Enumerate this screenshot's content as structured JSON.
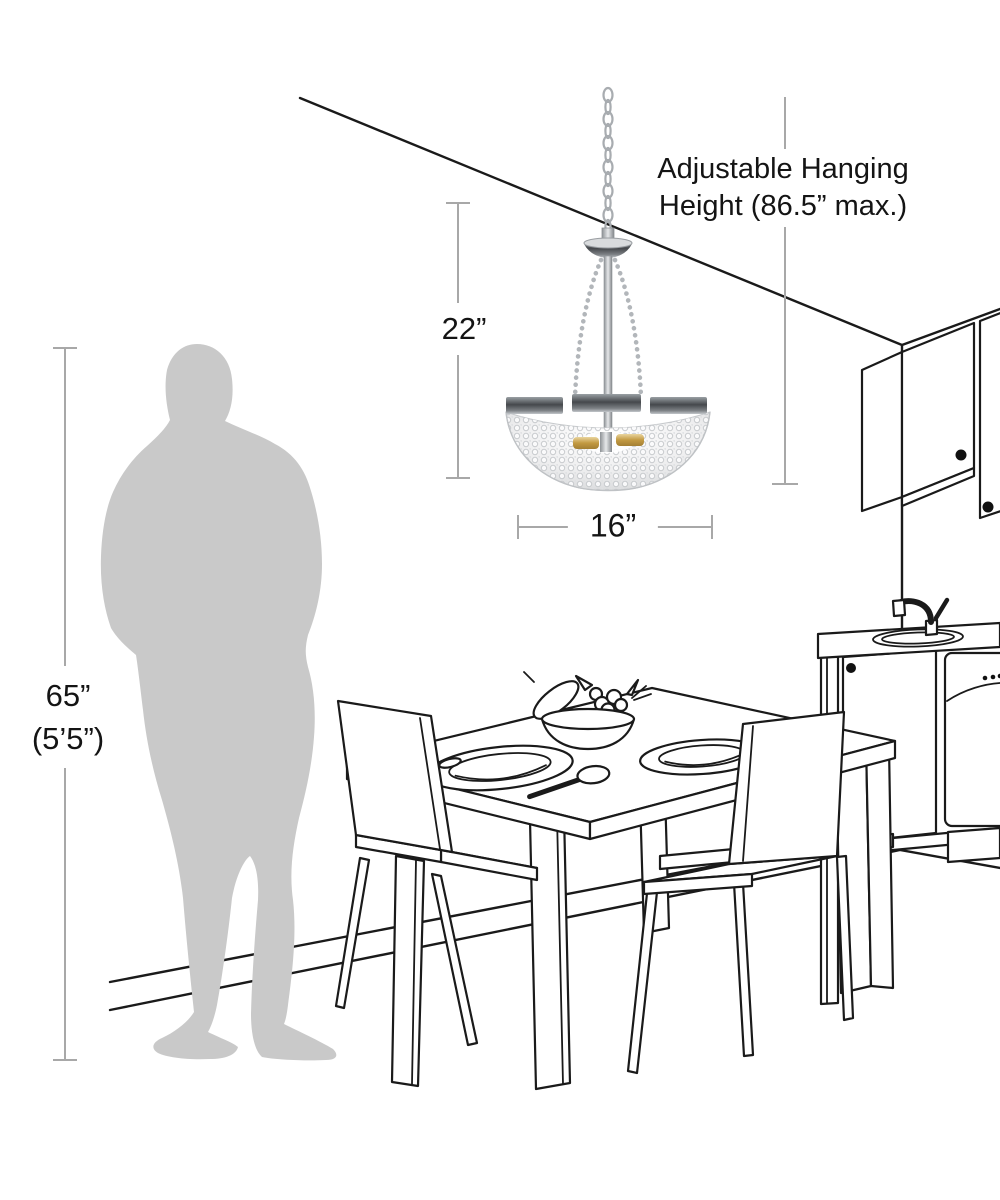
{
  "title": "Chandelier size and hanging height diagram",
  "labels": {
    "hanging_height_line1": "Adjustable Hanging",
    "hanging_height_line2": "Height (86.5” max.)",
    "fixture_height": "22”",
    "fixture_width": "16”",
    "person_height": "65”",
    "person_height_alt": "(5’5”)"
  },
  "colors": {
    "background": "#ffffff",
    "line_art": "#1a1a1a",
    "dimension_line": "#a8a8a8",
    "silhouette": "#c9c9c9",
    "label_text": "#141414",
    "chrome_band": "#55585c",
    "crystal": "#ececee",
    "candle_gold": "#caa352"
  },
  "scene_objects": {
    "fixture": "crystal-basket-chandelier",
    "room": "kitchen-dining-room-line-art",
    "scale_reference": "standing-person-silhouette"
  }
}
